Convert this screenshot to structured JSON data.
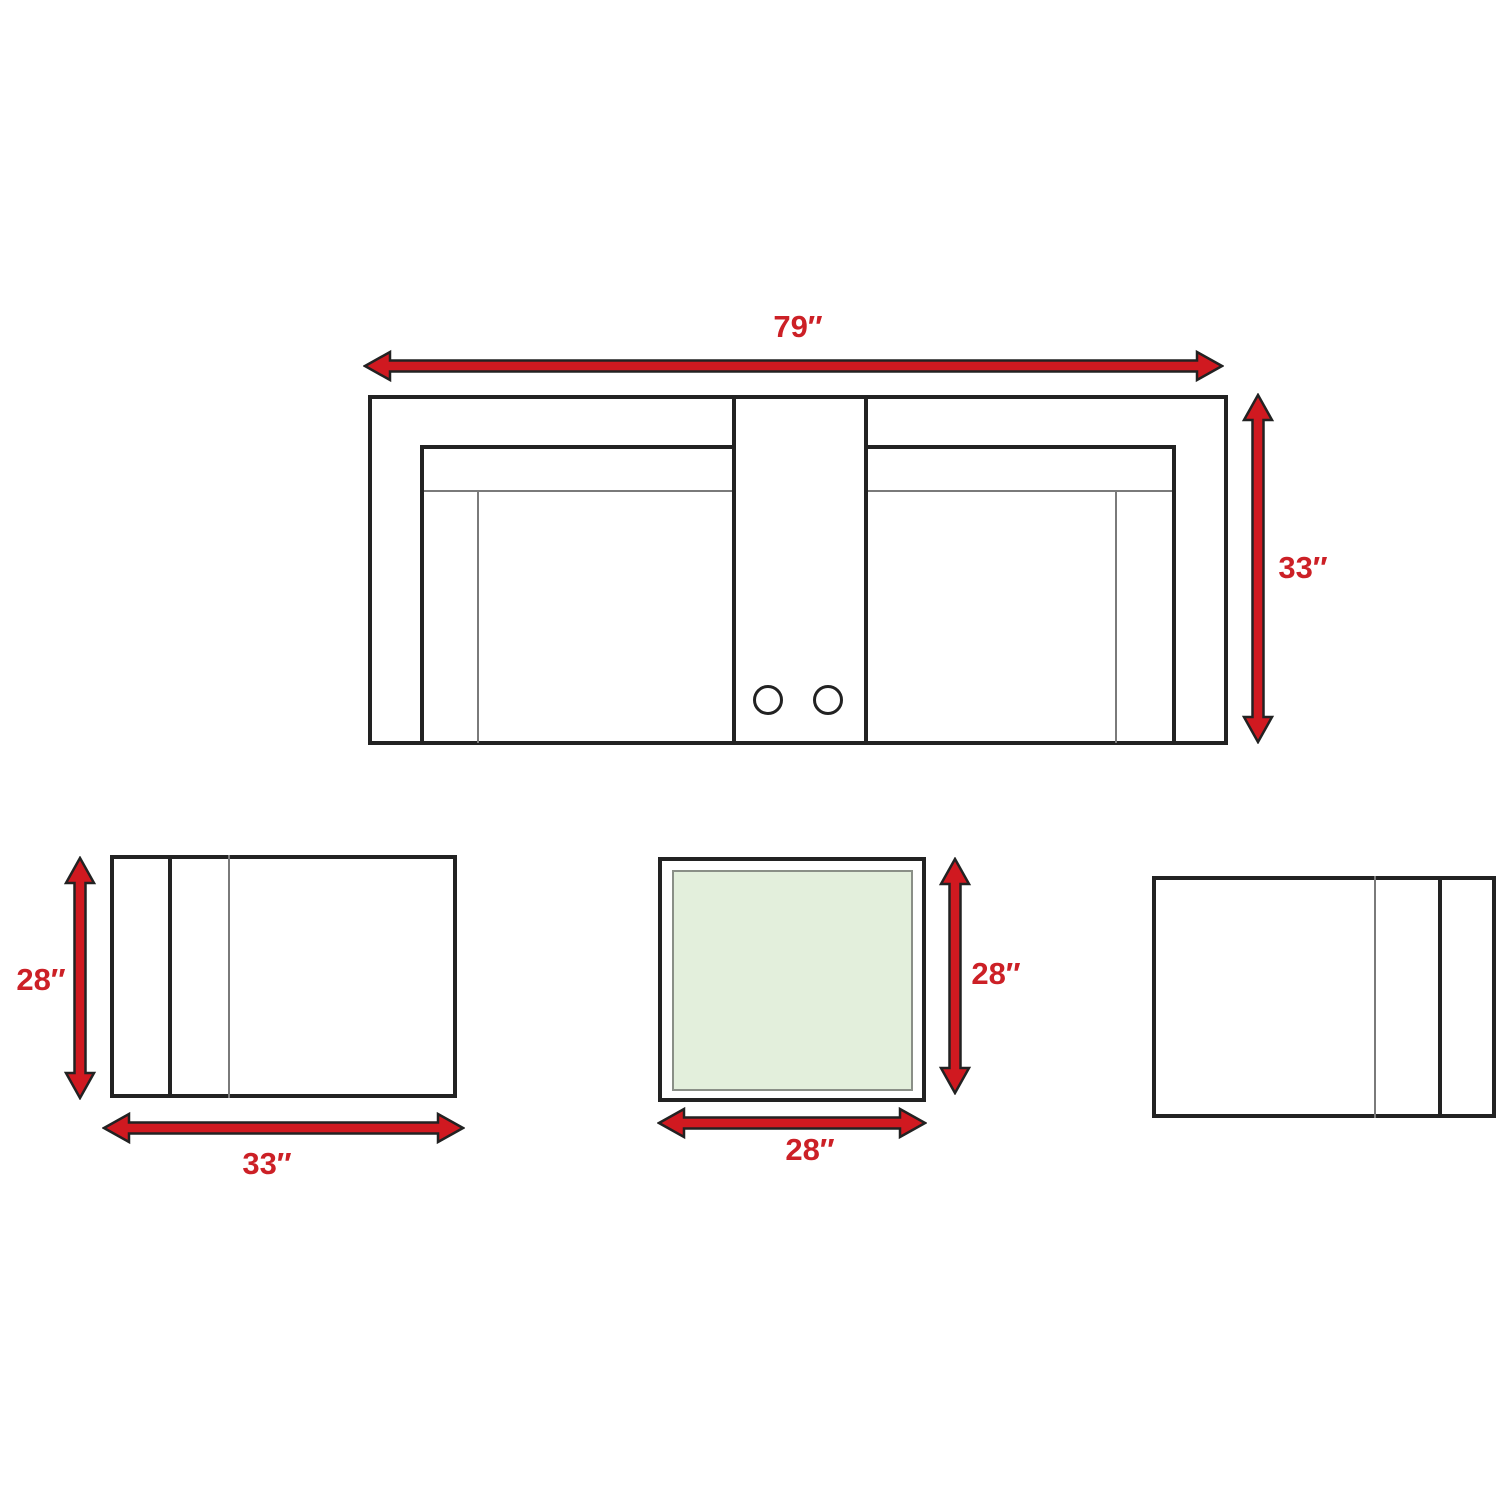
{
  "diagram_title": "Patio furniture set dimension diagram",
  "colors": {
    "arrow_red": "#d01920",
    "label_red": "#cc2026",
    "line_black": "#222222",
    "line_gray": "#7a7a7a",
    "table_top_green": "#e3efdc",
    "background": "#ffffff"
  },
  "sofa": {
    "width_label": "79″",
    "depth_label": "33″"
  },
  "lounge_chair_left": {
    "depth_label": "28″",
    "width_label": "33″"
  },
  "end_table": {
    "depth_label": "28″",
    "width_label": "28″"
  },
  "lounge_chair_right": {}
}
